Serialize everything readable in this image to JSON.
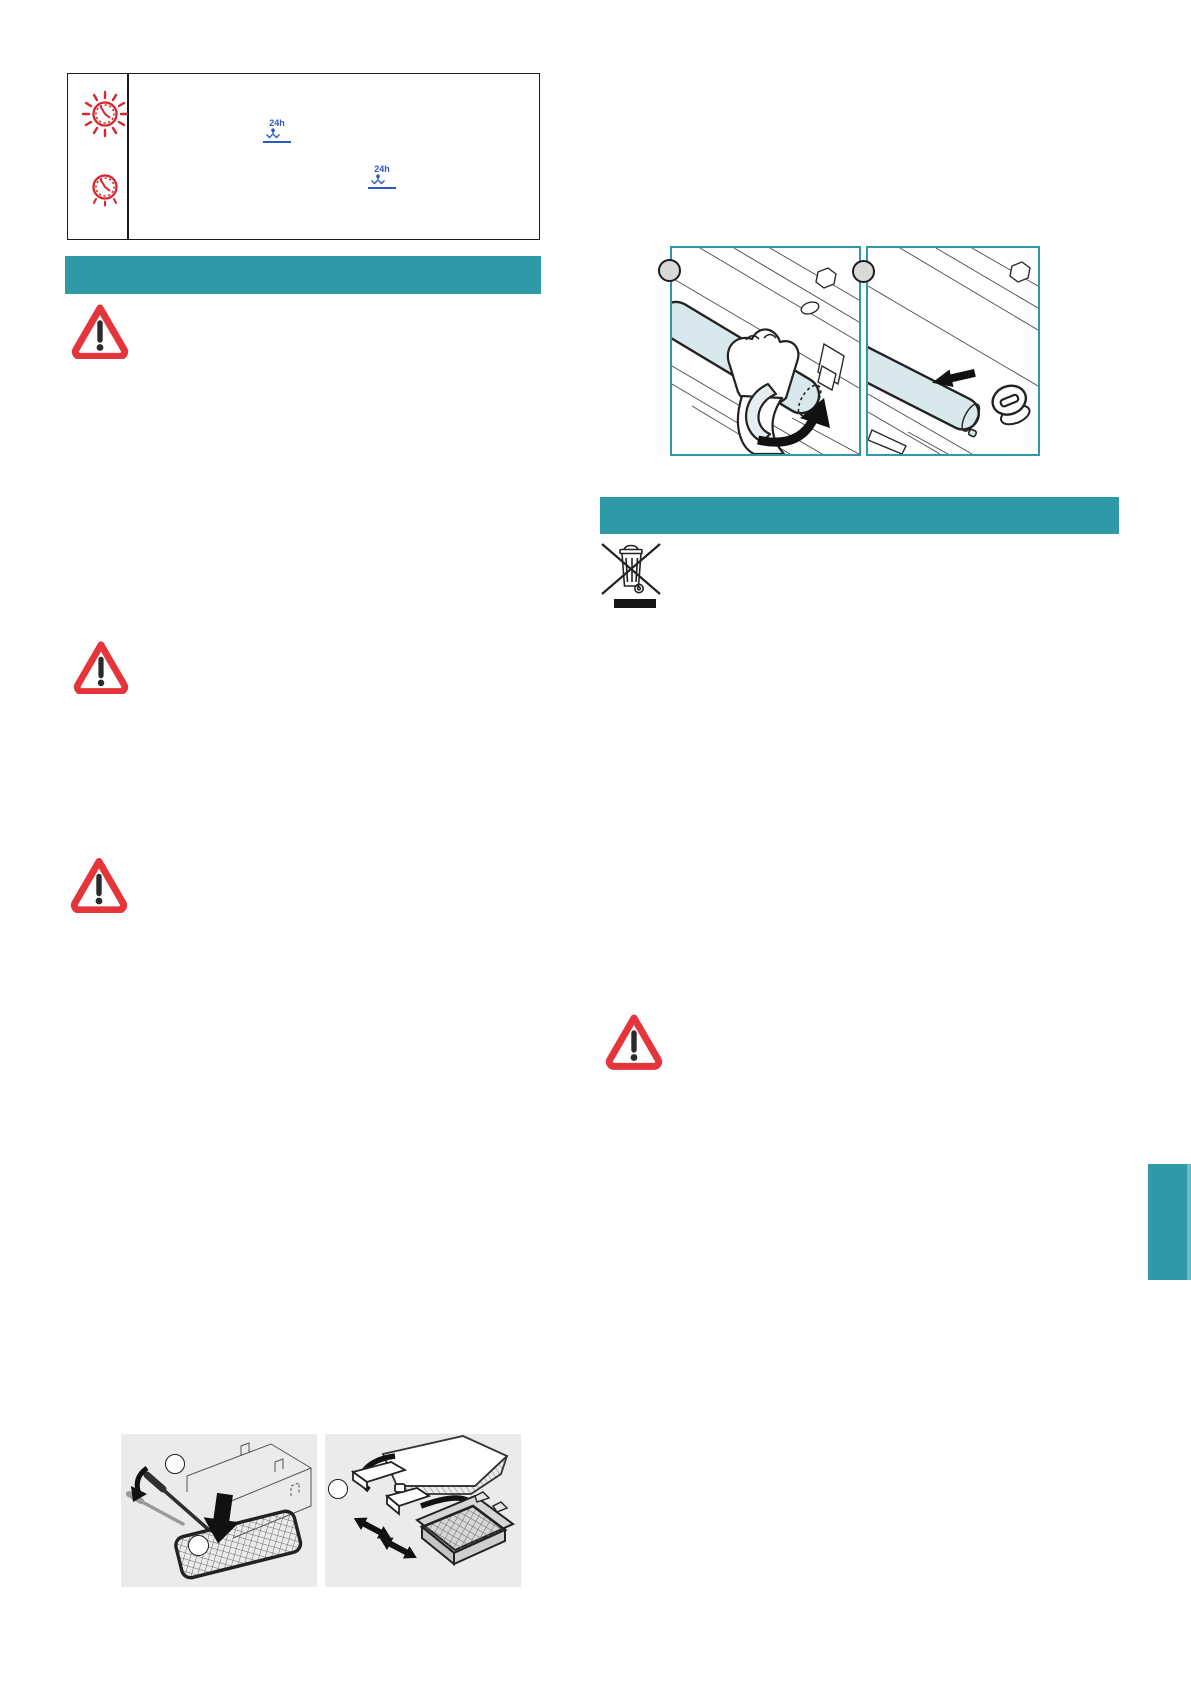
{
  "palette": {
    "teal": "#2f99a7",
    "teal_light": "#6ebac5",
    "warning_red": "#e6343b",
    "clock_red": "#d8262c",
    "badge_blue": "#2b57c8",
    "figure_bg": "#ebebeb",
    "art_line": "#2b2b2b",
    "cylinder_fill": "#d9e8ec",
    "step_circle_fill": "#d9d9d9"
  },
  "info_table": {
    "rows": [
      {
        "icon": "alarm-clock-flashing-icon",
        "badge": "24h"
      },
      {
        "icon": "alarm-clock-icon",
        "badge": "24h"
      }
    ]
  },
  "sections": {
    "left_header_text": "",
    "right_header_text": ""
  },
  "figures": {
    "lamp_replacement": {
      "panels": [
        {
          "step_marker": "",
          "icon": "hand-rotating-lamp-cylinder"
        },
        {
          "step_marker": "",
          "icon": "lamp-cylinder-slide-out"
        }
      ]
    },
    "weee": {
      "icon": "crossed-out-wheeled-bin"
    },
    "filter_service": {
      "panels": [
        {
          "step_markers": [
            "",
            ""
          ],
          "icon": "screwdriver-prying-filter-cover"
        },
        {
          "step_markers": [
            ""
          ],
          "icon": "lamp-connector-disconnect"
        }
      ]
    }
  },
  "warnings": {
    "count": 4
  }
}
